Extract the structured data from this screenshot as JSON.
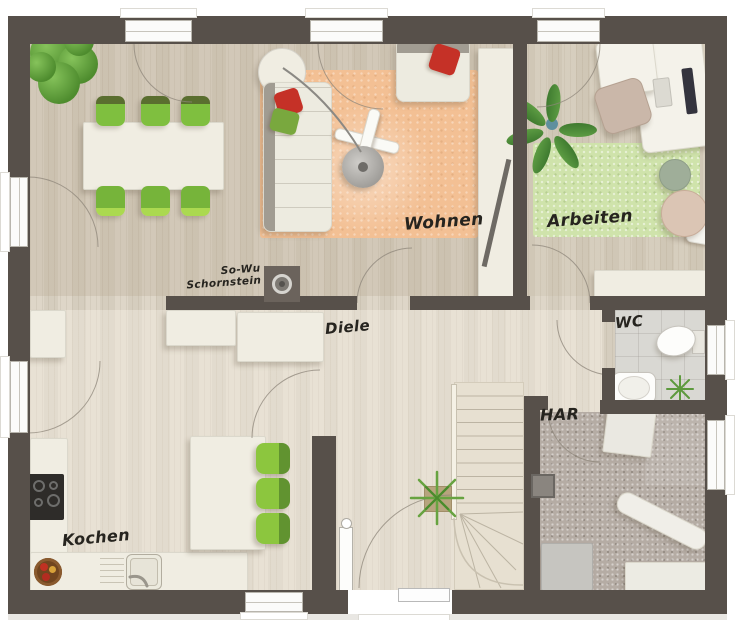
{
  "floorplan": {
    "rooms": {
      "living": {
        "label": "Wohnen"
      },
      "office": {
        "label": "Arbeiten"
      },
      "hall": {
        "label": "Diele"
      },
      "wc": {
        "label": "WC"
      },
      "utility": {
        "label": "HAR"
      },
      "kitchen": {
        "label": "Kochen"
      }
    },
    "chimney": {
      "line1": "So-Wu",
      "line2": "Schornstein"
    },
    "colors": {
      "wall": "#57504a",
      "wood_floor": "#dbd3c4",
      "living_rug": "#f3c094",
      "office_rug": "#cfe3ab",
      "chair_green": "#8cc63e",
      "accent_red": "#c53127",
      "utility_floor": "#b5aca4",
      "wc_floor": "#d9d8d3"
    }
  }
}
